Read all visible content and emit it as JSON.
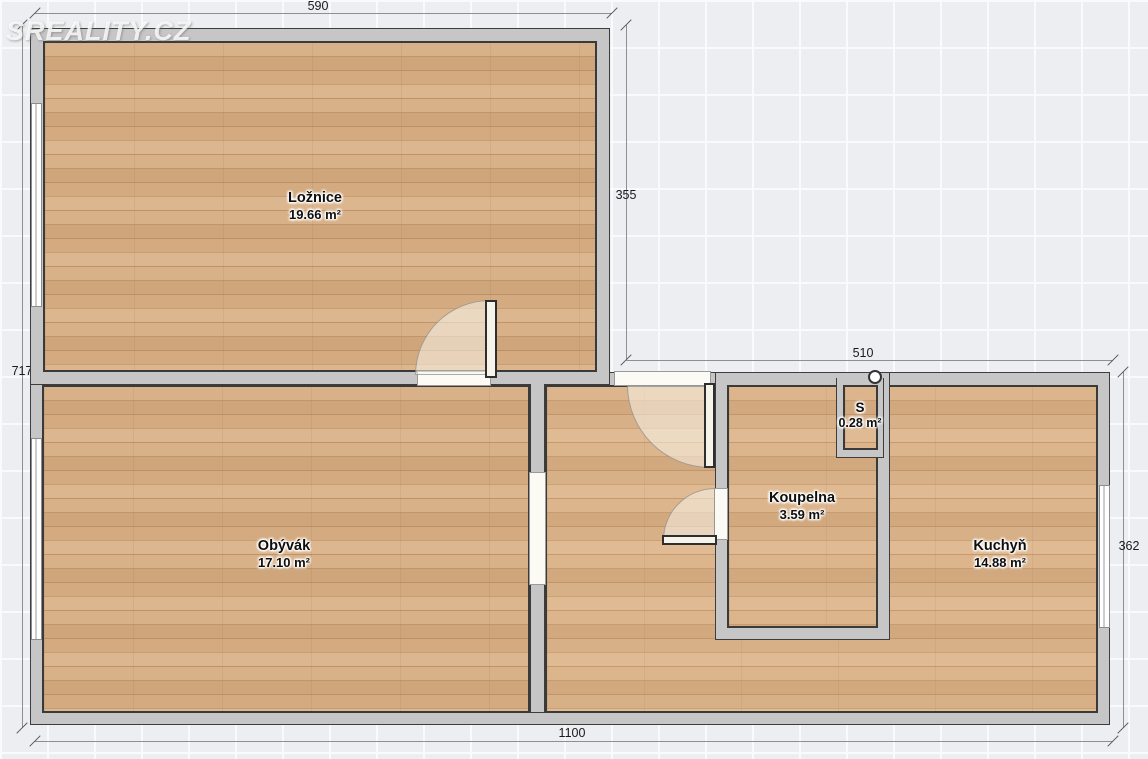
{
  "watermark": {
    "text": "SREALITY.CZ"
  },
  "rooms": [
    {
      "name": "Ložnice",
      "area": "19.66 m²"
    },
    {
      "name": "Obývák",
      "area": "17.10 m²"
    },
    {
      "name": "Koupelna",
      "area": "3.59 m²"
    },
    {
      "name": "Kuchyň",
      "area": "14.88 m²"
    },
    {
      "name": "S",
      "area": "0.28 m²"
    }
  ],
  "dimensions": {
    "top": "590",
    "bedroom_right": "355",
    "entry_top": "510",
    "left": "717",
    "kitchen_right": "362",
    "bottom": "1100"
  },
  "colors": {
    "wall": "#c6c6c6",
    "wall_outline": "#3d3d3d",
    "floor_wood": "#cda177",
    "background": "#edeef2",
    "dimension_text": "#1a1a1a",
    "watermark": "#ffffff"
  }
}
